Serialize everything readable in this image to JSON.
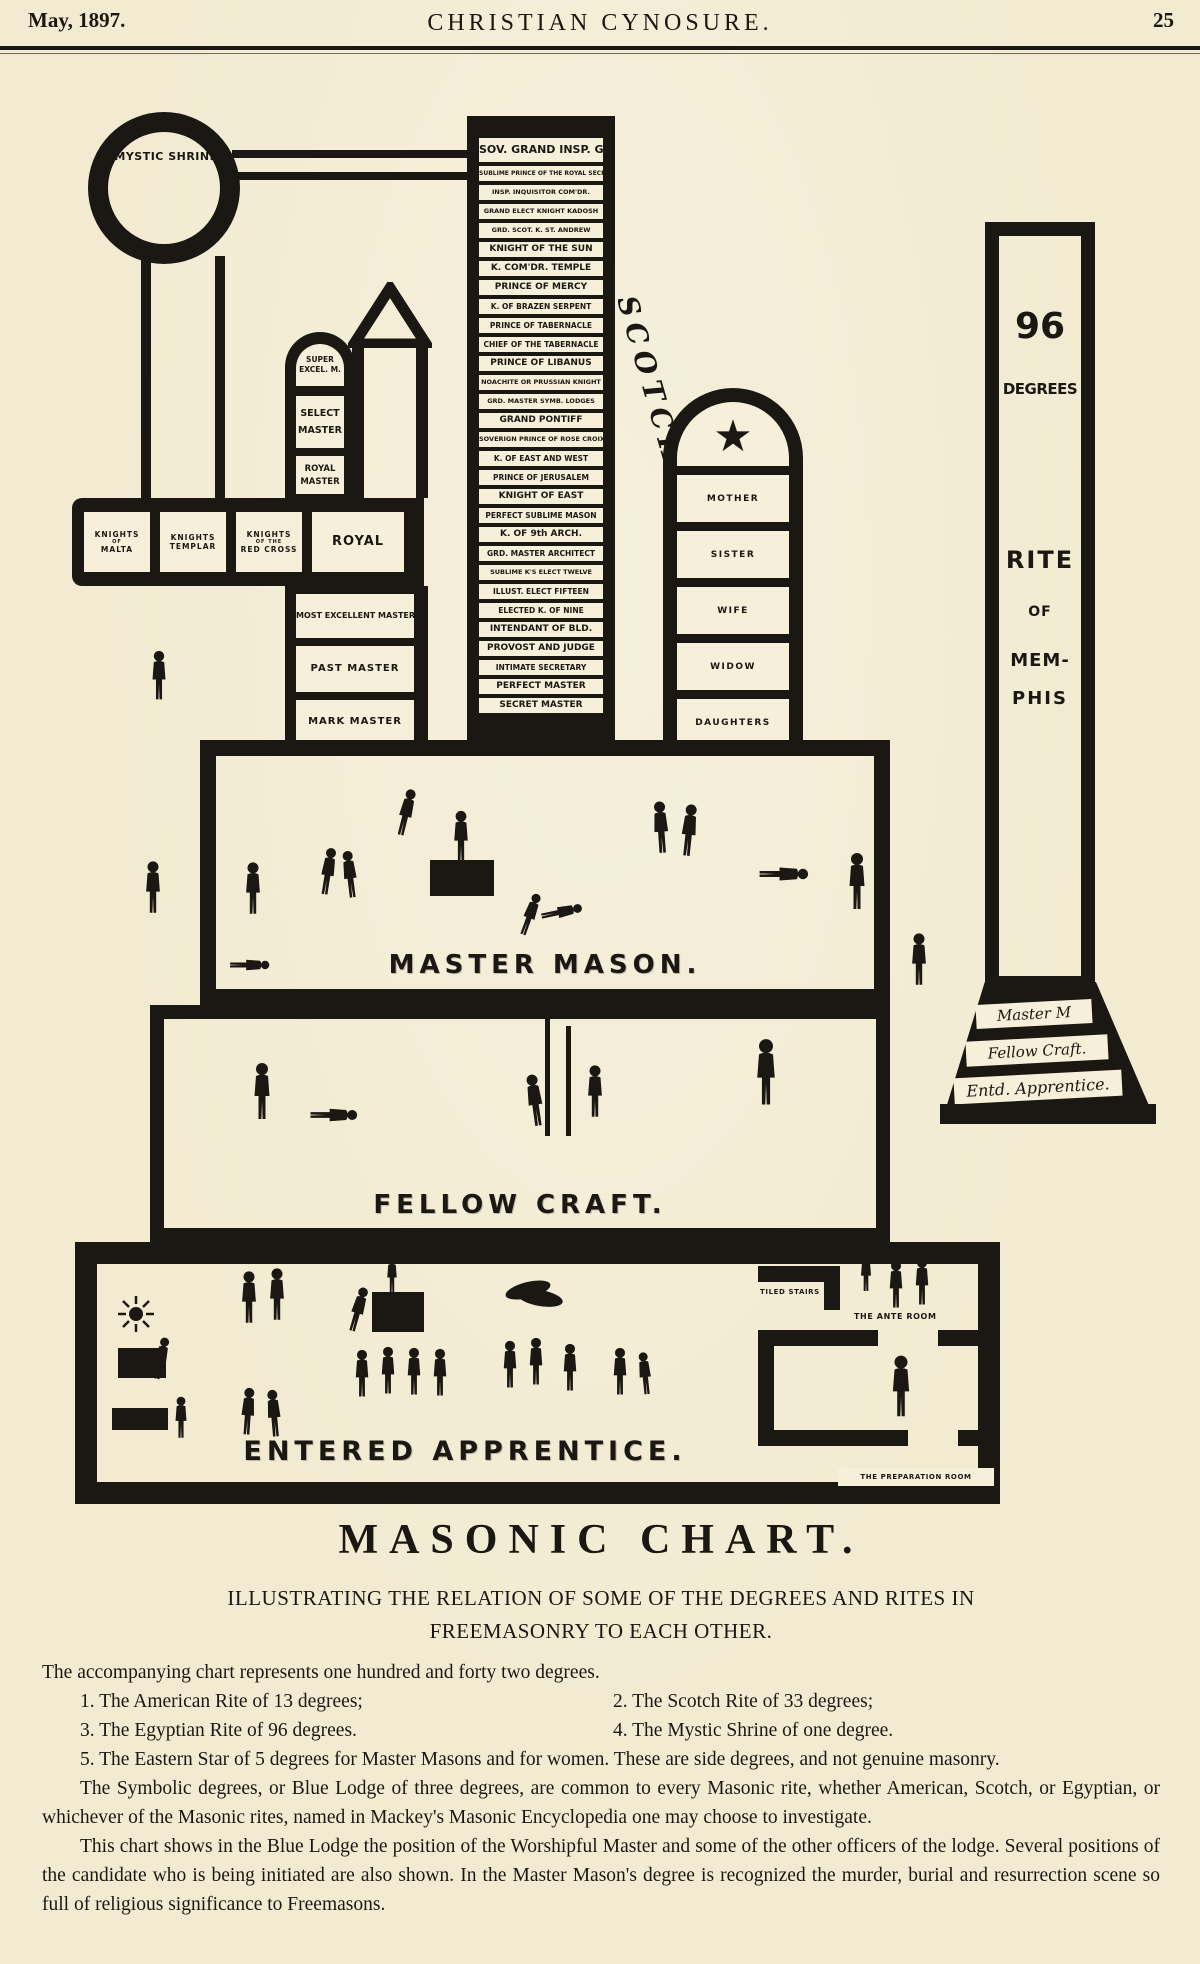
{
  "header": {
    "date": "May, 1897.",
    "title": "CHRISTIAN CYNOSURE.",
    "page_number": "25"
  },
  "chart": {
    "mystic_shrine": "MYSTIC SHRINE",
    "scotch_label": "SCOTCH RITE.",
    "scotch_degrees": [
      "SOV. GRAND INSP. GEN.",
      "SUBLIME PRINCE OF THE ROYAL SECRET",
      "INSP. INQUISITOR COM'DR.",
      "GRAND ELECT KNIGHT KADOSH",
      "GRD. SCOT. K. ST. ANDREW",
      "KNIGHT OF THE SUN",
      "K. COM'DR. TEMPLE",
      "PRINCE OF MERCY",
      "K. OF BRAZEN SERPENT",
      "PRINCE OF TABERNACLE",
      "CHIEF OF THE TABERNACLE",
      "PRINCE OF LIBANUS",
      "NOACHITE OR PRUSSIAN KNIGHT",
      "GRD. MASTER SYMB. LODGES",
      "GRAND PONTIFF",
      "SOVERIGN PRINCE OF ROSE CROIX",
      "K. OF EAST AND WEST",
      "PRINCE OF JERUSALEM",
      "KNIGHT OF EAST",
      "PERFECT SUBLIME MASON",
      "K. OF 9th ARCH.",
      "GRD. MASTER ARCHITECT",
      "SUBLIME K'S ELECT TWELVE",
      "ILLUST. ELECT FIFTEEN",
      "ELECTED K. OF NINE",
      "INTENDANT OF BLD.",
      "PROVOST AND JUDGE",
      "INTIMATE SECRETARY",
      "PERFECT MASTER",
      "SECRET MASTER"
    ],
    "american": {
      "arch_l1": "SUPER",
      "arch_l2": "EXCEL. M.",
      "select_l1": "SELECT",
      "select_l2": "MASTER",
      "royal_l1": "ROYAL",
      "royal_l2": "MASTER",
      "royal_arch": "ROYAL ARCH",
      "knights": [
        {
          "l1": "KNIGHTS",
          "l2": "OF",
          "l3": "MALTA"
        },
        {
          "l1": "KNIGHTS",
          "l2": "",
          "l3": "TEMPLAR"
        },
        {
          "l1": "KNIGHTS",
          "l2": "OF THE",
          "l3": "RED CROSS"
        }
      ],
      "lower": [
        "MOST EXCELLENT MASTER",
        "PAST MASTER",
        "MARK MASTER"
      ]
    },
    "eastern_star": {
      "star": "★",
      "labels": [
        "MOTHER",
        "SISTER",
        "WIFE",
        "WIDOW",
        "DAUGHTERS"
      ]
    },
    "memphis": {
      "big": "96",
      "degrees": "DEGREES",
      "lines": [
        "RITE",
        "OF",
        "MEM-",
        "PHIS"
      ],
      "base": [
        "Master M",
        "Fellow Craft.",
        "Entd. Apprentice."
      ]
    },
    "rooms": {
      "master": "MASTER MASON.",
      "fellow": "FELLOW CRAFT.",
      "entered": "ENTERED APPRENTICE."
    },
    "sublabels": {
      "tiled": "TILED STAIRS",
      "ante": "THE ANTE ROOM",
      "prep": "THE PREPARATION ROOM"
    }
  },
  "article": {
    "title": "MASONIC CHART.",
    "subtitle1": "ILLUSTRATING THE RELATION OF SOME OF THE DEGREES AND RITES IN",
    "subtitle2": "FREEMASONRY TO EACH OTHER.",
    "intro": "The accompanying chart represents one hundred and forty two degrees.",
    "items": [
      "1.  The American Rite of 13 degrees;",
      "2.  The Scotch Rite of 33 degrees;",
      "3.  The Egyptian Rite of 96 degrees.",
      "4.  The Mystic Shrine of one degree.",
      "5.  The Eastern Star of 5 degrees for Master Masons and for women.  These are side degrees, and not genuine masonry."
    ],
    "para1": "The Symbolic degrees, or Blue Lodge of three degrees, are common to every Masonic rite, whether American, Scotch, or Egyptian, or whichever of the Masonic rites, named in Mackey's Masonic Encyclopedia one may choose to investigate.",
    "para2": "This chart shows in the Blue Lodge the position of the Worshipful Master and some of the other officers of the lodge.  Several positions of the candidate who is being initiated are also shown.  In the Master Mason's degree is recognized the murder, burial and resurrection scene so full of religious significance to Freemasons."
  },
  "colors": {
    "paper": "#f2ebd2",
    "ink": "#1b1712"
  }
}
